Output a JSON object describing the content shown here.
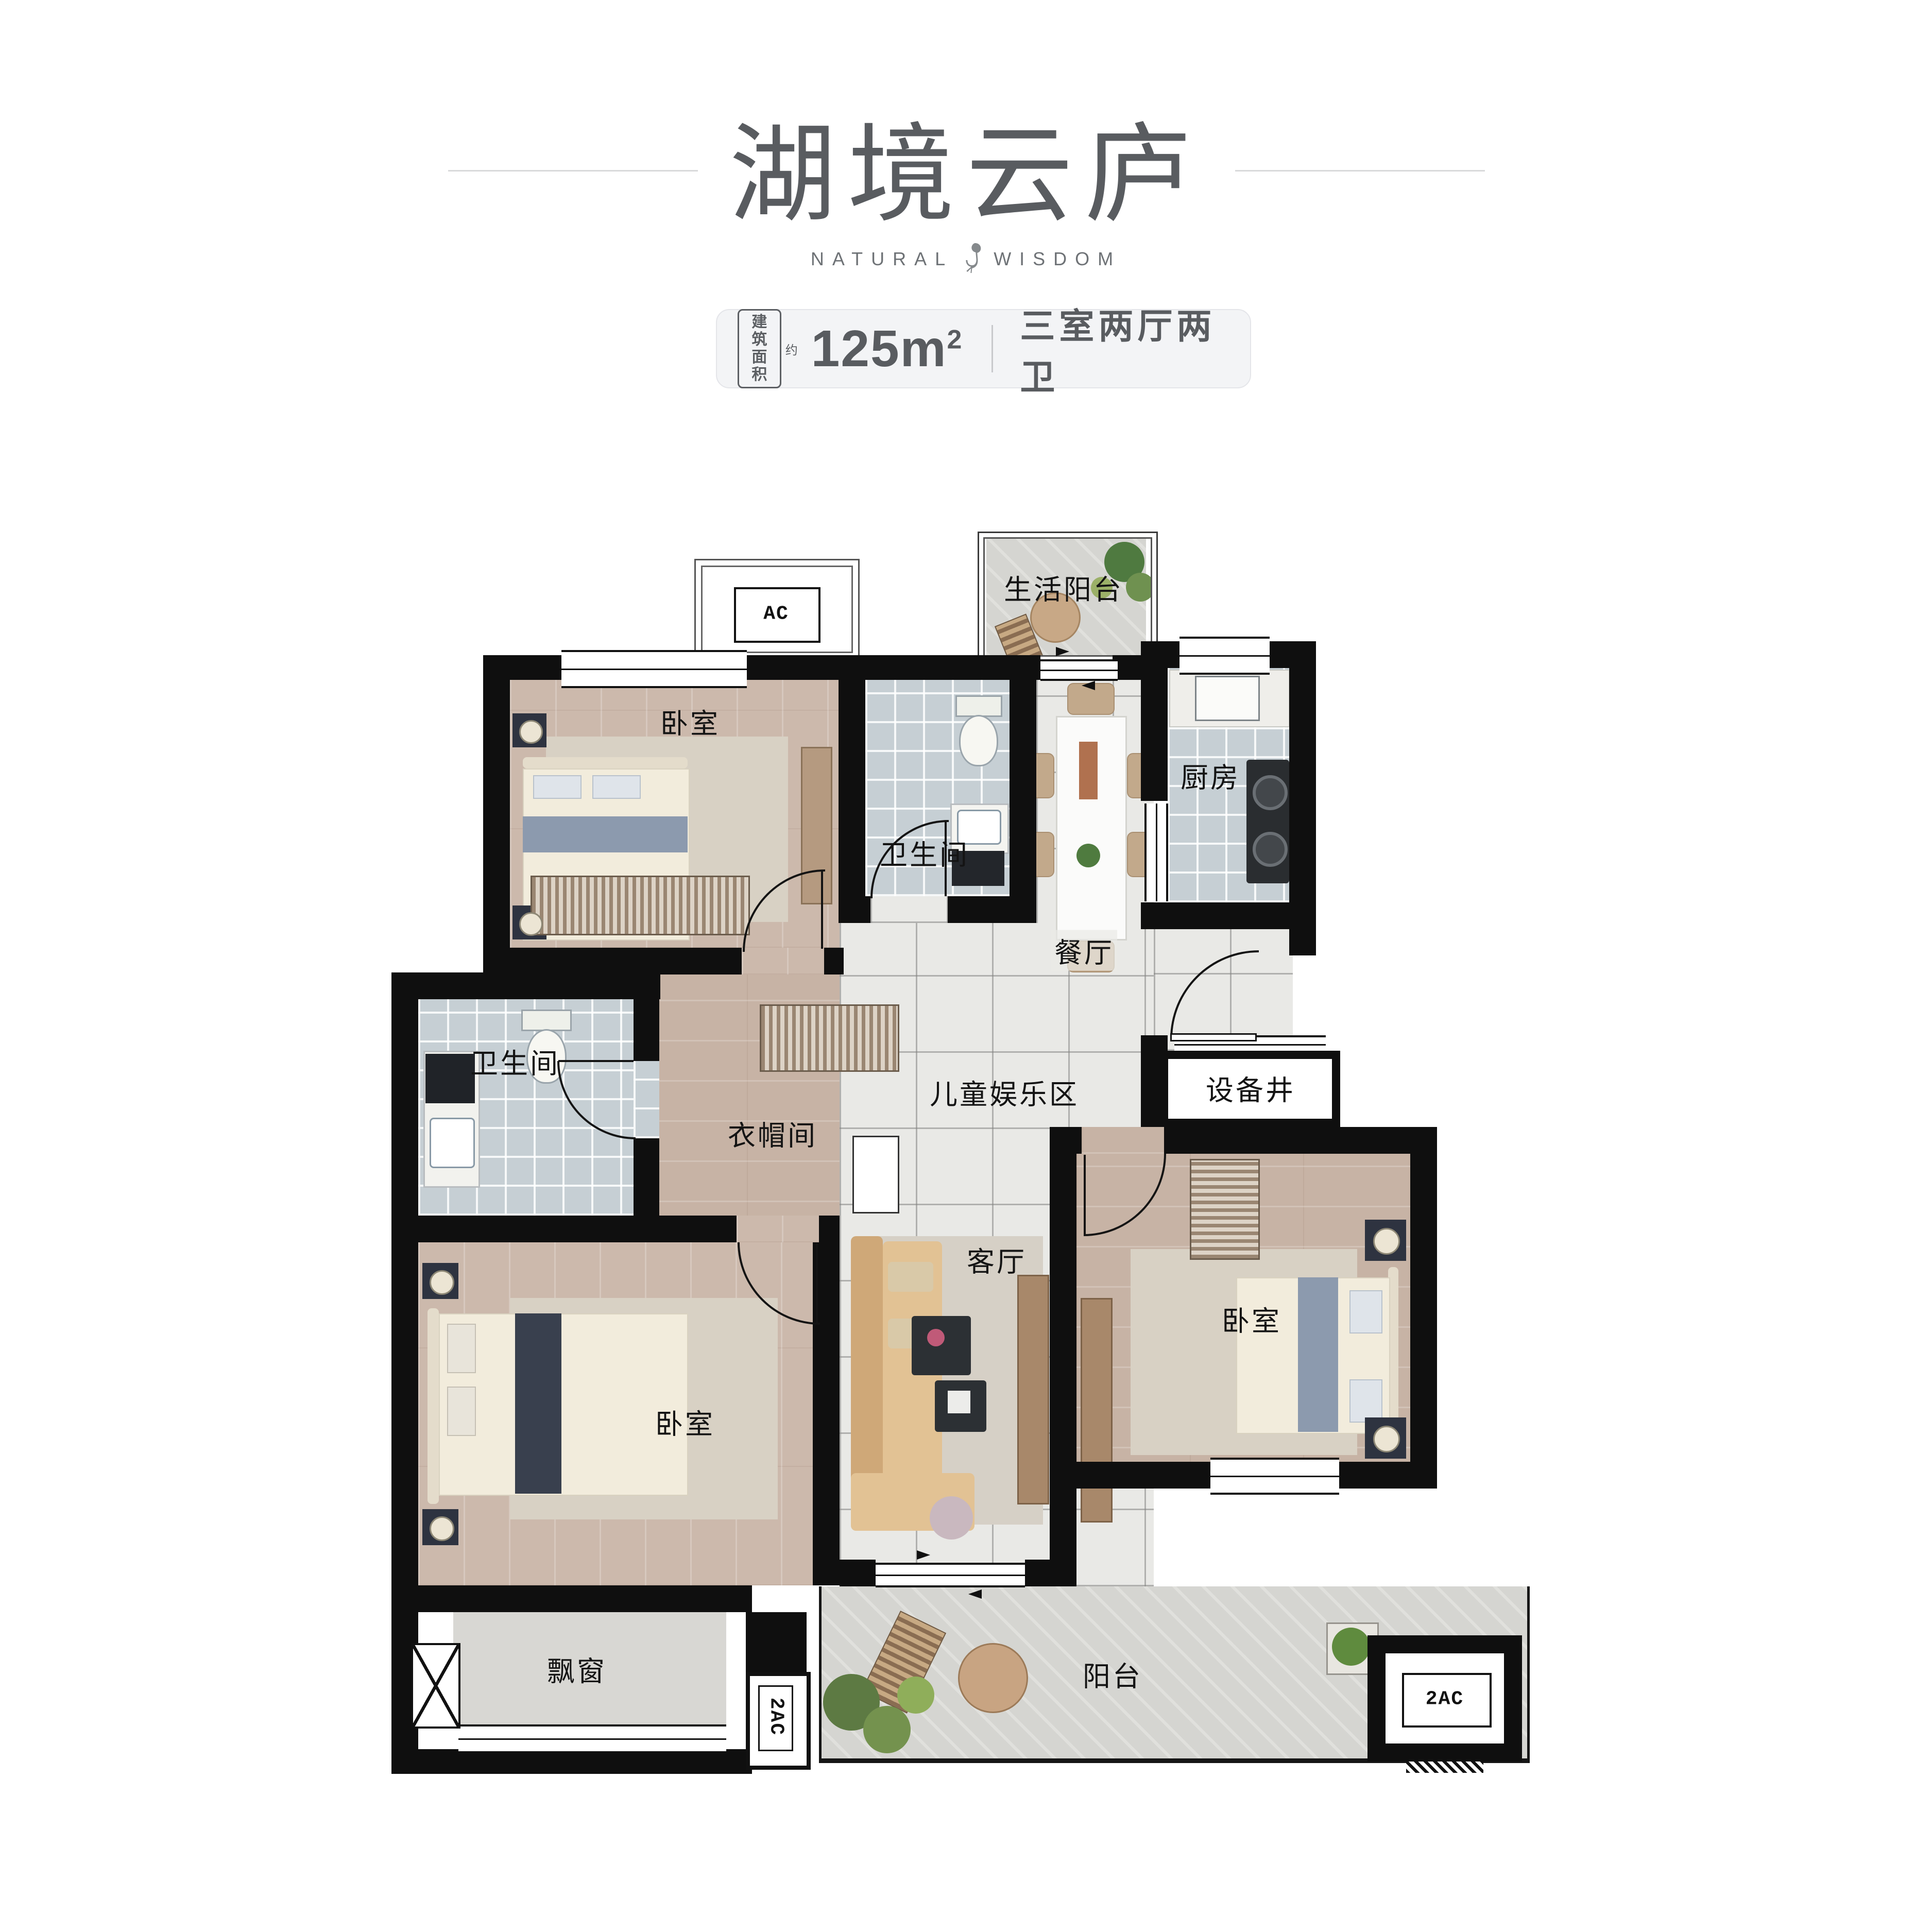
{
  "header": {
    "title": "湖境云庐",
    "brand_left": "NATURAL",
    "brand_right": "WISDOM",
    "badge": {
      "area_tag_line1": "建筑",
      "area_tag_line2": "面积",
      "area_approx": "约",
      "area_value": "125m",
      "area_unit_sup": "2",
      "layout_text": "三室两厅两卫"
    }
  },
  "floorplan": {
    "labels": {
      "life_balcony": "生活阳台",
      "bedroom_top": "卧室",
      "bathroom_top": "卫生间",
      "kitchen": "厨房",
      "dining": "餐厅",
      "kids_zone": "儿童娱乐区",
      "utility_shaft": "设备井",
      "bathroom_left": "卫生间",
      "cloakroom": "衣帽间",
      "living_room": "客厅",
      "bedroom_left": "卧室",
      "bedroom_right": "卧室",
      "bay_window": "飘窗",
      "balcony": "阳台",
      "ac_top": "AC",
      "ac_bottom_left": "2AC",
      "ac_bottom_right": "2AC"
    },
    "colors": {
      "wall": "#0f0f0f",
      "wood_floor": "#ccb9ac",
      "tile_floor": "#c6cfd4",
      "stone_floor": "#e9e9e6",
      "balcony_floor": "#d5d5d1",
      "accent_text": "#595c60"
    }
  }
}
